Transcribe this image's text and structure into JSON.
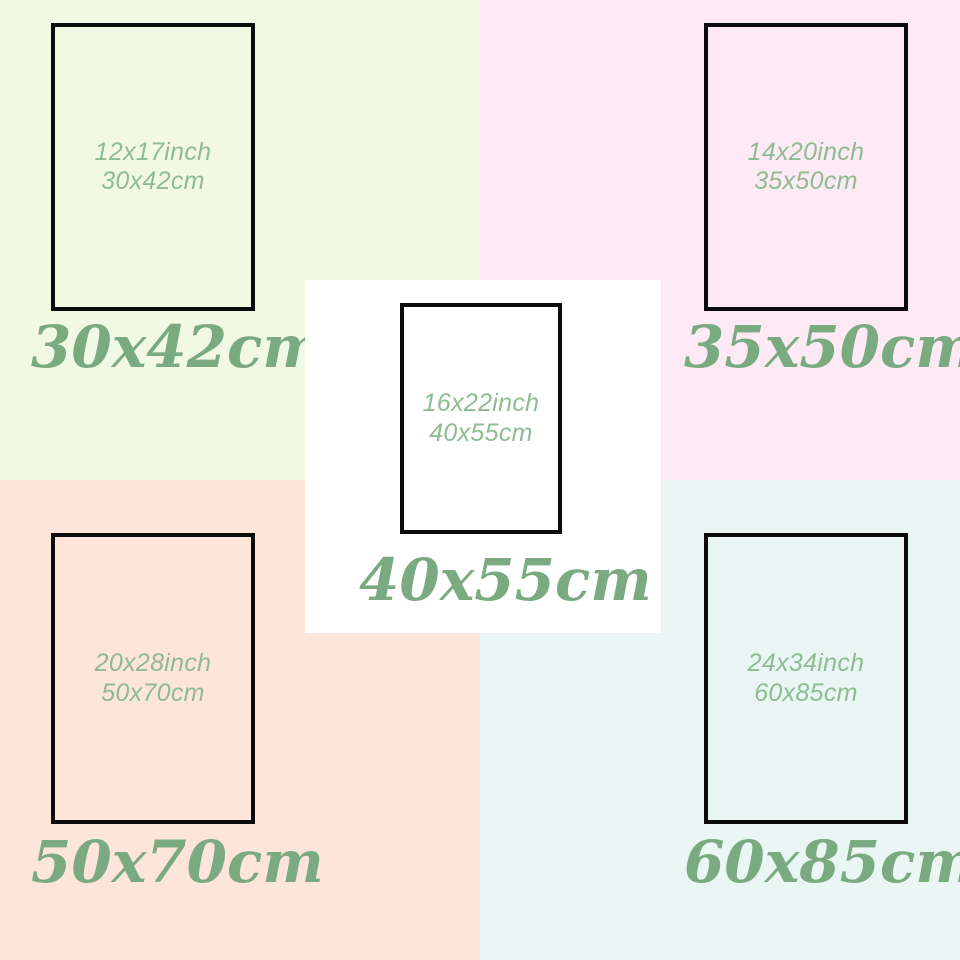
{
  "title": "Poster size comparison chart",
  "colors": {
    "frame_border": "#0c0c0c",
    "inner_text": "#8fbb92",
    "label_text": "#7aaa80",
    "top_left_bg": "#f1f9e5",
    "top_right_bg": "#fdeaf5",
    "bottom_left_bg": "#fde5d9",
    "bottom_right_bg": "#e9f6f4",
    "center_bg": "#ffffff"
  },
  "panels": [
    {
      "name": "30x42cm",
      "inch_label": "12x17inch",
      "cm_label": "30x42cm",
      "size_label": "30x42cm",
      "bg": "#f1f9e5"
    },
    {
      "name": "35x50cm",
      "inch_label": "14x20inch",
      "cm_label": "35x50cm",
      "size_label": "35x50cm",
      "bg": "#fdeaf5"
    },
    {
      "name": "50x70cm",
      "inch_label": "20x28inch",
      "cm_label": "50x70cm",
      "size_label": "50x70cm",
      "bg": "#fde5d9"
    },
    {
      "name": "60x85cm",
      "inch_label": "24x34inch",
      "cm_label": "60x85cm",
      "size_label": "60x85cm",
      "bg": "#e9f6f4"
    },
    {
      "name": "40x55cm",
      "inch_label": "16x22inch",
      "cm_label": "40x55cm",
      "size_label": "40x55cm",
      "bg": "#ffffff"
    }
  ]
}
